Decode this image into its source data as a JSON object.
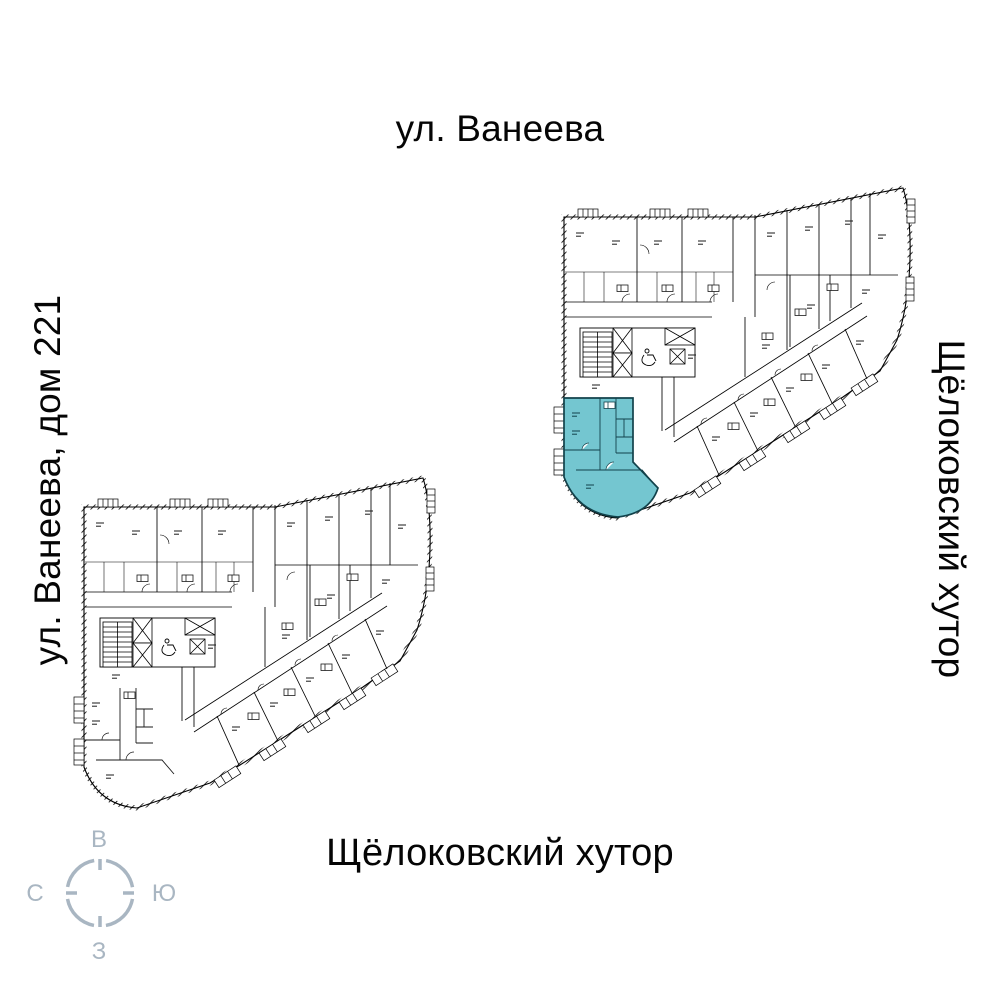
{
  "labels": {
    "top": "ул. Ванеева",
    "left": "ул. Ванеева, дом 221",
    "right": "Щёлоковский хутор",
    "bottom": "Щёлоковский хутор"
  },
  "compass": {
    "top": "В",
    "right": "Ю",
    "bottom": "З",
    "left": "С",
    "color": "#a9b6c2"
  },
  "highlight_apartment": {
    "fill": "#74c6d0",
    "outline": "#12424b"
  },
  "icons": {
    "elevator_shaft": "x-crossed-box",
    "stairs": "tread-lines",
    "accessibility": "wheelchair",
    "balcony": "ticked-rect",
    "door": "quarter-arc"
  }
}
